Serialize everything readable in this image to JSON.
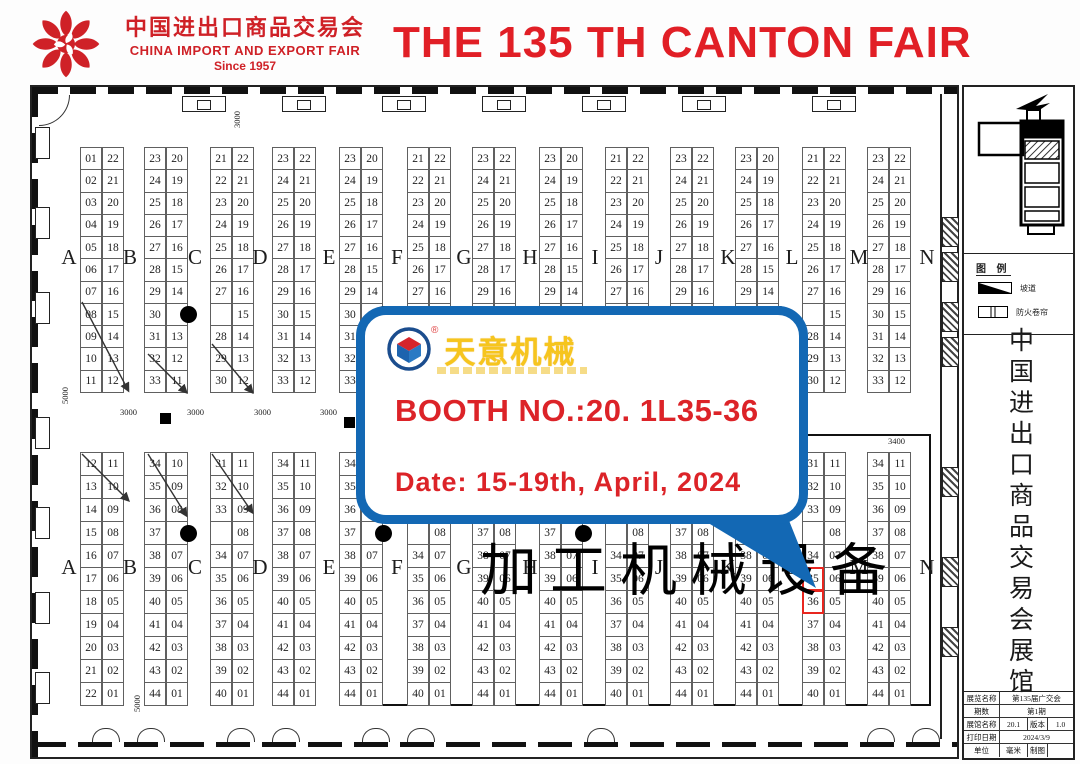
{
  "header": {
    "logo_cn": "中国进出口商品交易会",
    "logo_en": "CHINA IMPORT AND EXPORT FAIR",
    "logo_since": "Since 1957",
    "title": "THE 135 TH CANTON FAIR"
  },
  "callout": {
    "brand": "天意机械",
    "reg_mark": "®",
    "booth_line": "BOOTH NO.:20. 1L35-36",
    "date_line": "Date: 15-19th, April, 2024"
  },
  "colors": {
    "title_red": "#e11f26",
    "callout_blue": "#1368b4",
    "brand_gold": "#f6c51e",
    "highlight_red": "#e8261f"
  },
  "map": {
    "category_label": "加工机械设备",
    "aisle_letters": [
      "A",
      "B",
      "C",
      "D",
      "E",
      "F",
      "G",
      "H",
      "I",
      "J",
      "K",
      "L",
      "M",
      "N"
    ],
    "dimension_labels": [
      "5000",
      "3000",
      "3000",
      "3000",
      "3000",
      "3400",
      "3000",
      "5000"
    ],
    "highlighted_booths": [
      "35",
      "36"
    ],
    "top_strips": [
      {
        "left": [
          "01",
          "02",
          "03",
          "04",
          "05",
          "06",
          "07",
          "08",
          "09",
          "10",
          "11"
        ],
        "right": [
          "22",
          "21",
          "20",
          "19",
          "18",
          "17",
          "16",
          "15",
          "14",
          "13",
          "12"
        ]
      },
      {
        "left": [
          "23",
          "24",
          "25",
          "26",
          "27",
          "28",
          "29",
          "30",
          "31",
          "32",
          "33"
        ],
        "right": [
          "20",
          "19",
          "18",
          "17",
          "16",
          "15",
          "14",
          "",
          "13",
          "12",
          "11"
        ],
        "dot_row": 7
      },
      {
        "left": [
          "21",
          "22",
          "23",
          "24",
          "25",
          "26",
          "27",
          "",
          "28",
          "29",
          "30"
        ],
        "right": [
          "22",
          "21",
          "20",
          "19",
          "18",
          "17",
          "16",
          "15",
          "14",
          "13",
          "12"
        ]
      },
      {
        "left": [
          "23",
          "24",
          "25",
          "26",
          "27",
          "28",
          "29",
          "30",
          "31",
          "32",
          "33"
        ],
        "right": [
          "22",
          "21",
          "20",
          "19",
          "18",
          "17",
          "16",
          "15",
          "14",
          "13",
          "12"
        ]
      },
      {
        "left": [
          "23",
          "24",
          "25",
          "26",
          "27",
          "28",
          "29",
          "30",
          "31",
          "32",
          "33"
        ],
        "right": [
          "20",
          "19",
          "18",
          "17",
          "16",
          "15",
          "14",
          "",
          "13",
          "12",
          "11"
        ],
        "dot_row": 7
      },
      {
        "left": [
          "21",
          "22",
          "23",
          "24",
          "25",
          "26",
          "27",
          "",
          "28",
          "29",
          "30"
        ],
        "right": [
          "22",
          "21",
          "20",
          "19",
          "18",
          "17",
          "16",
          "15",
          "14",
          "13",
          "12"
        ]
      },
      {
        "left": [
          "23",
          "24",
          "25",
          "26",
          "27",
          "28",
          "29",
          "30",
          "31",
          "32",
          "33"
        ],
        "right": [
          "22",
          "21",
          "20",
          "19",
          "18",
          "17",
          "16",
          "15",
          "14",
          "13",
          "12"
        ]
      },
      {
        "left": [
          "23",
          "24",
          "25",
          "26",
          "27",
          "28",
          "29",
          "30",
          "31",
          "32",
          "33"
        ],
        "right": [
          "20",
          "19",
          "18",
          "17",
          "16",
          "15",
          "14",
          "",
          "13",
          "12",
          "11"
        ],
        "dot_row": 7
      },
      {
        "left": [
          "21",
          "22",
          "23",
          "24",
          "25",
          "26",
          "27",
          "",
          "28",
          "29",
          "30"
        ],
        "right": [
          "22",
          "21",
          "20",
          "19",
          "18",
          "17",
          "16",
          "15",
          "14",
          "13",
          "12"
        ]
      },
      {
        "left": [
          "23",
          "24",
          "25",
          "26",
          "27",
          "28",
          "29",
          "30",
          "31",
          "32",
          "33"
        ],
        "right": [
          "22",
          "21",
          "20",
          "19",
          "18",
          "17",
          "16",
          "15",
          "14",
          "13",
          "12"
        ]
      },
      {
        "left": [
          "23",
          "24",
          "25",
          "26",
          "27",
          "28",
          "29",
          "30",
          "31",
          "32",
          "33"
        ],
        "right": [
          "20",
          "19",
          "18",
          "17",
          "16",
          "15",
          "14",
          "",
          "13",
          "12",
          "11"
        ],
        "dot_row": 7
      },
      {
        "left": [
          "21",
          "22",
          "23",
          "24",
          "25",
          "26",
          "27",
          "",
          "28",
          "29",
          "30"
        ],
        "right": [
          "22",
          "21",
          "20",
          "19",
          "18",
          "17",
          "16",
          "15",
          "14",
          "13",
          "12"
        ]
      },
      {
        "left": [
          "23",
          "24",
          "25",
          "26",
          "27",
          "28",
          "29",
          "30",
          "31",
          "32",
          "33"
        ],
        "right": [
          "22",
          "21",
          "20",
          "19",
          "18",
          "17",
          "16",
          "15",
          "14",
          "13",
          "12"
        ]
      }
    ],
    "bottom_strips": [
      {
        "left": [
          "12",
          "13",
          "14",
          "15",
          "16",
          "17",
          "18",
          "19",
          "20",
          "21",
          "22"
        ],
        "right": [
          "11",
          "10",
          "09",
          "08",
          "07",
          "06",
          "05",
          "04",
          "03",
          "02",
          "01"
        ]
      },
      {
        "left": [
          "34",
          "35",
          "36",
          "37",
          "38",
          "39",
          "40",
          "41",
          "42",
          "43",
          "44"
        ],
        "right": [
          "10",
          "09",
          "08",
          "",
          "07",
          "06",
          "05",
          "04",
          "03",
          "02",
          "01"
        ],
        "dot_row": 3
      },
      {
        "left": [
          "31",
          "32",
          "33",
          "",
          "34",
          "35",
          "36",
          "37",
          "38",
          "39",
          "40"
        ],
        "right": [
          "11",
          "10",
          "09",
          "08",
          "07",
          "06",
          "05",
          "04",
          "03",
          "02",
          "01"
        ]
      },
      {
        "left": [
          "34",
          "35",
          "36",
          "37",
          "38",
          "39",
          "40",
          "41",
          "42",
          "43",
          "44"
        ],
        "right": [
          "11",
          "10",
          "09",
          "08",
          "07",
          "06",
          "05",
          "04",
          "03",
          "02",
          "01"
        ]
      },
      {
        "left": [
          "34",
          "35",
          "36",
          "37",
          "38",
          "39",
          "40",
          "41",
          "42",
          "43",
          "44"
        ],
        "right": [
          "10",
          "09",
          "08",
          "",
          "07",
          "06",
          "05",
          "04",
          "03",
          "02",
          "01"
        ],
        "dot_row": 3
      },
      {
        "left": [
          "31",
          "32",
          "33",
          "",
          "34",
          "35",
          "36",
          "37",
          "38",
          "39",
          "40"
        ],
        "right": [
          "11",
          "10",
          "09",
          "08",
          "07",
          "06",
          "05",
          "04",
          "03",
          "02",
          "01"
        ]
      },
      {
        "left": [
          "34",
          "35",
          "36",
          "37",
          "38",
          "39",
          "40",
          "41",
          "42",
          "43",
          "44"
        ],
        "right": [
          "11",
          "10",
          "09",
          "08",
          "07",
          "06",
          "05",
          "04",
          "03",
          "02",
          "01"
        ]
      },
      {
        "left": [
          "34",
          "35",
          "36",
          "37",
          "38",
          "39",
          "40",
          "41",
          "42",
          "43",
          "44"
        ],
        "right": [
          "10",
          "09",
          "08",
          "",
          "07",
          "06",
          "05",
          "04",
          "03",
          "02",
          "01"
        ],
        "dot_row": 3
      },
      {
        "left": [
          "31",
          "32",
          "33",
          "",
          "34",
          "35",
          "36",
          "37",
          "38",
          "39",
          "40"
        ],
        "right": [
          "11",
          "10",
          "09",
          "08",
          "07",
          "06",
          "05",
          "04",
          "03",
          "02",
          "01"
        ]
      },
      {
        "left": [
          "34",
          "35",
          "36",
          "37",
          "38",
          "39",
          "40",
          "41",
          "42",
          "43",
          "44"
        ],
        "right": [
          "11",
          "10",
          "09",
          "08",
          "07",
          "06",
          "05",
          "04",
          "03",
          "02",
          "01"
        ]
      },
      {
        "left": [
          "34",
          "35",
          "36",
          "37",
          "38",
          "39",
          "40",
          "41",
          "42",
          "43",
          "44"
        ],
        "right": [
          "10",
          "09",
          "08",
          "",
          "07",
          "06",
          "05",
          "04",
          "03",
          "02",
          "01"
        ],
        "dot_row": 3
      },
      {
        "left": [
          "31",
          "32",
          "33",
          "",
          "34",
          "35",
          "36",
          "37",
          "38",
          "39",
          "40"
        ],
        "right": [
          "11",
          "10",
          "09",
          "08",
          "07",
          "06",
          "05",
          "04",
          "03",
          "02",
          "01"
        ],
        "highlight_rows": [
          5,
          6
        ]
      },
      {
        "left": [
          "34",
          "35",
          "36",
          "37",
          "38",
          "39",
          "40",
          "41",
          "42",
          "43",
          "44"
        ],
        "right": [
          "11",
          "10",
          "09",
          "08",
          "07",
          "06",
          "05",
          "04",
          "03",
          "02",
          "01"
        ]
      }
    ]
  },
  "sidebar": {
    "legend": {
      "title": "图 例",
      "item1": "坡道",
      "item2": "防火卷帘"
    },
    "vertical_title": "中国进出口商品交易会展馆",
    "table": {
      "rows": [
        {
          "label": "展览名称",
          "value": "第135届广交会"
        },
        {
          "label": "期数",
          "value": "第1期"
        },
        {
          "label": "展馆名称",
          "value": "20.1",
          "label2": "版本",
          "value2": "1.0"
        },
        {
          "label": "打印日期",
          "value": "2024/3/9"
        },
        {
          "label": "单位",
          "value": "毫米",
          "label2": "制图",
          "value2": ""
        }
      ]
    }
  }
}
